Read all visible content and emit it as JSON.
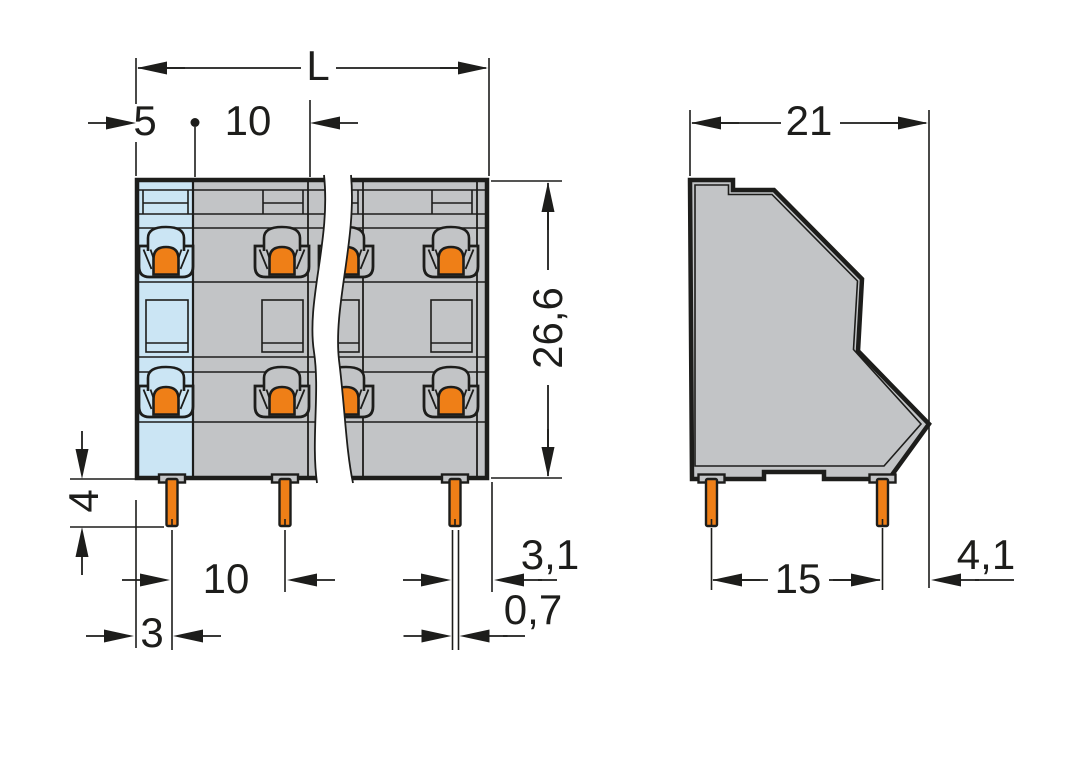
{
  "drawing_type": "terminal-block-dimension-drawing",
  "views": {
    "front": "front-view-with-break",
    "side": "side-profile-view"
  },
  "dims": {
    "overall_length": "L",
    "pole_offset": "5",
    "pitch": "10",
    "height": "26,6",
    "pin_length": "4",
    "pin_pitch": "10",
    "pin_edge_offset": "3",
    "pin_to_edge": "3,1",
    "pin_width": "0,7",
    "depth": "21",
    "pin_row_spacing": "15",
    "overhang": "4,1"
  },
  "colors": {
    "ink": "#1d1d1b",
    "gray": "#c2c4c6",
    "blue": "#cbe5f4",
    "orange": "#ef7f17",
    "paper": "#ffffff"
  }
}
